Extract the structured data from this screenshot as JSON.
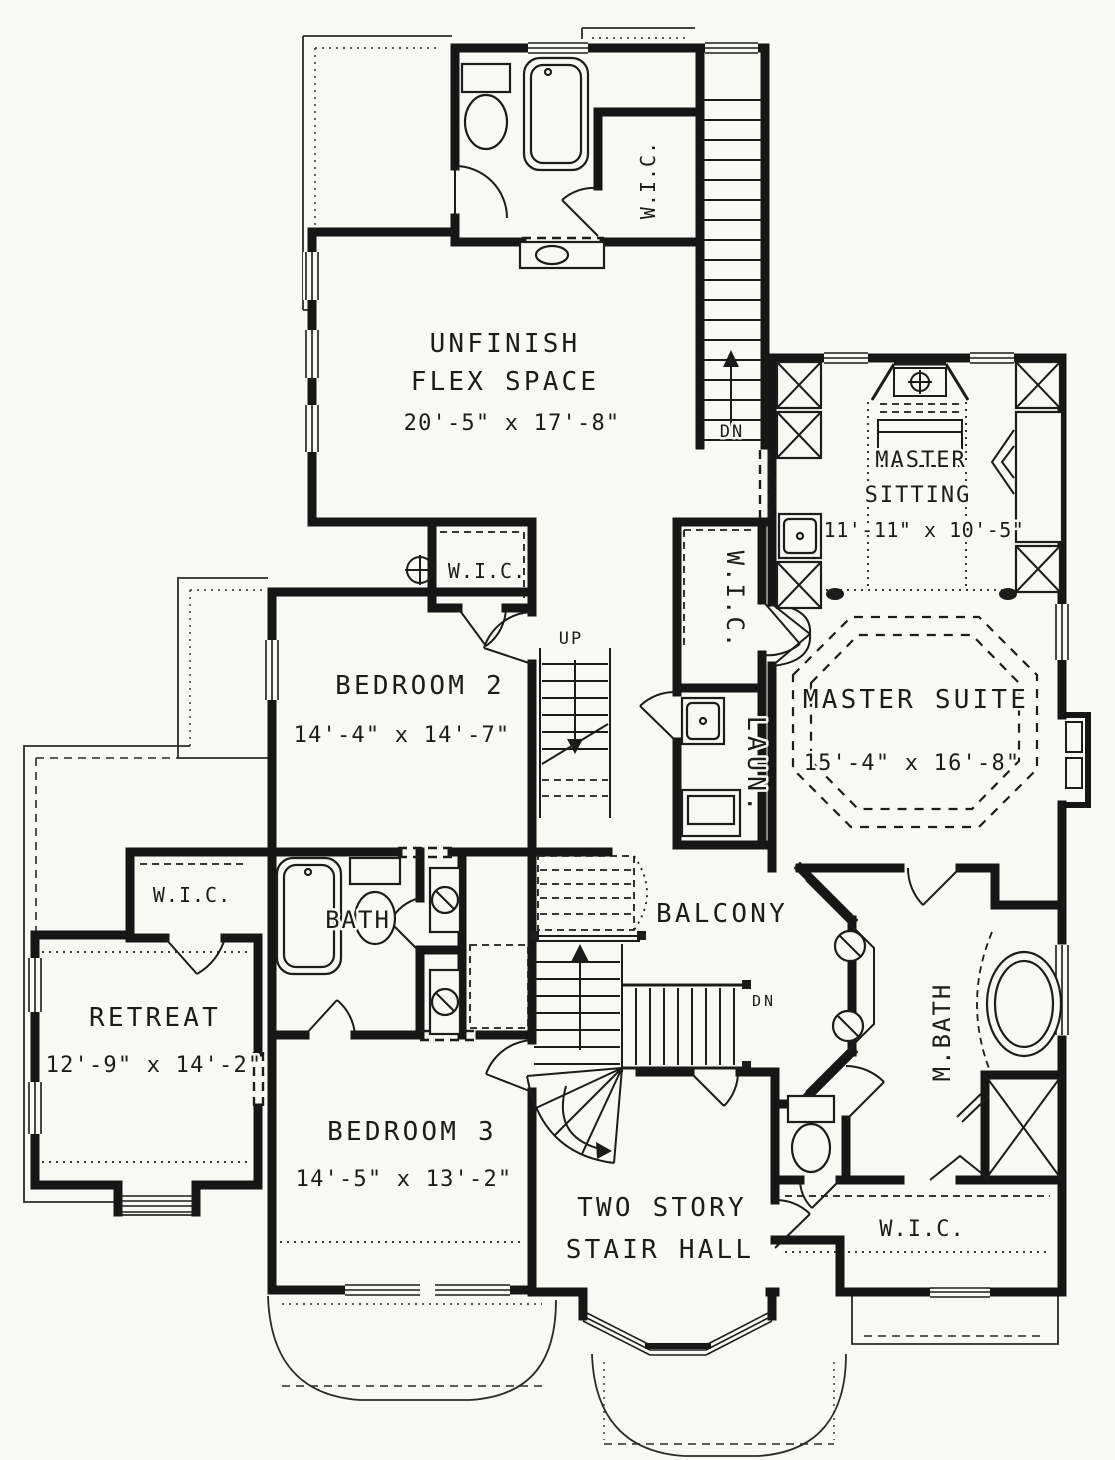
{
  "colors": {
    "ink": "#1c1c1c",
    "paper": "#f8f8f4"
  },
  "rooms": {
    "flex": {
      "line1": "UNFINISH",
      "line2": "FLEX SPACE",
      "dims": "20'-5\" x 17'-8\""
    },
    "master_sitting": {
      "line1": "MASTER",
      "line2": "SITTING",
      "dims": "11'-11\" x 10'-5\""
    },
    "bedroom2": {
      "name": "BEDROOM 2",
      "dims": "14'-4\" x 14'-7\""
    },
    "master_suite": {
      "name": "MASTER SUITE",
      "dims": "15'-4\" x 16'-8\""
    },
    "retreat": {
      "name": "RETREAT",
      "dims": "12'-9\" x 14'-2\""
    },
    "bedroom3": {
      "name": "BEDROOM 3",
      "dims": "14'-5\" x 13'-2\""
    },
    "stair_hall": {
      "line1": "TWO STORY",
      "line2": "STAIR HALL"
    },
    "balcony": {
      "name": "BALCONY"
    },
    "bath": {
      "name": "BATH"
    },
    "master_bath": {
      "name": "M.BATH"
    },
    "laundry": {
      "name": "LAUN."
    },
    "wic_flex": {
      "name": "W.I.C."
    },
    "wic_bedroom2": {
      "name": "W.I.C."
    },
    "wic_hall": {
      "name": "W.I.C."
    },
    "wic_retreat": {
      "name": "W.I.C."
    },
    "wic_master": {
      "name": "W.I.C."
    }
  },
  "stairs": {
    "up": "UP",
    "down_top": "DN",
    "down_balcony": "DN"
  }
}
